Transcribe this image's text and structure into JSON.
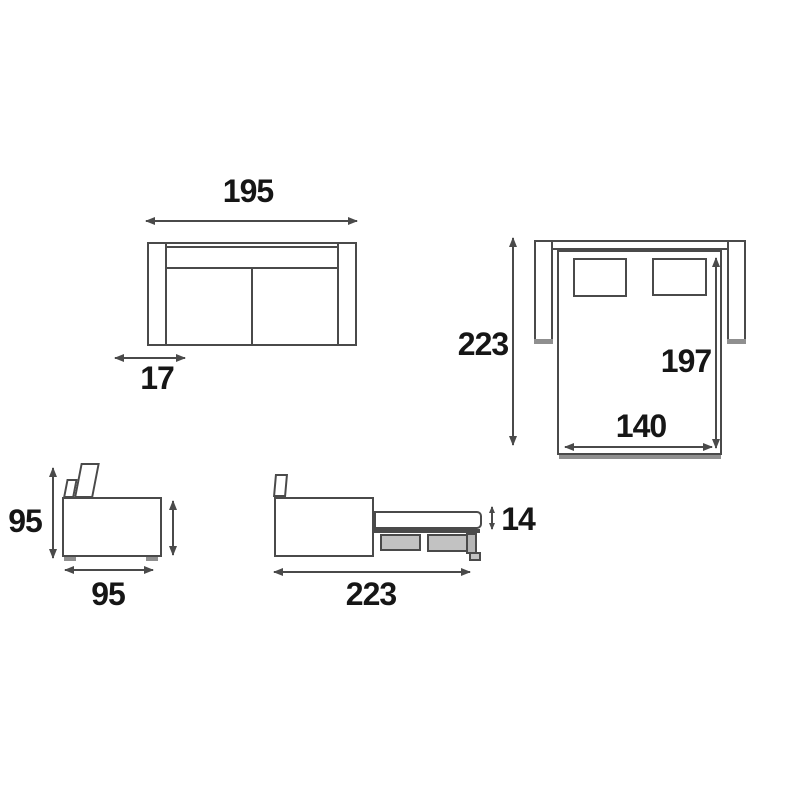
{
  "colors": {
    "line": "#4a4a4a",
    "text": "#161616",
    "mech_fill": "#c2c2c2",
    "leg_fill": "#b5b5b5",
    "shadow": "#8f8f8f",
    "background": "#ffffff"
  },
  "dims": {
    "front_overall_width": "195",
    "front_armrest_width": "17",
    "open_overall_depth": "223",
    "bed_length": "197",
    "bed_width": "140",
    "side_height": "95",
    "side_depth": "95",
    "open_overall_length": "223",
    "mattress_thickness": "14"
  }
}
